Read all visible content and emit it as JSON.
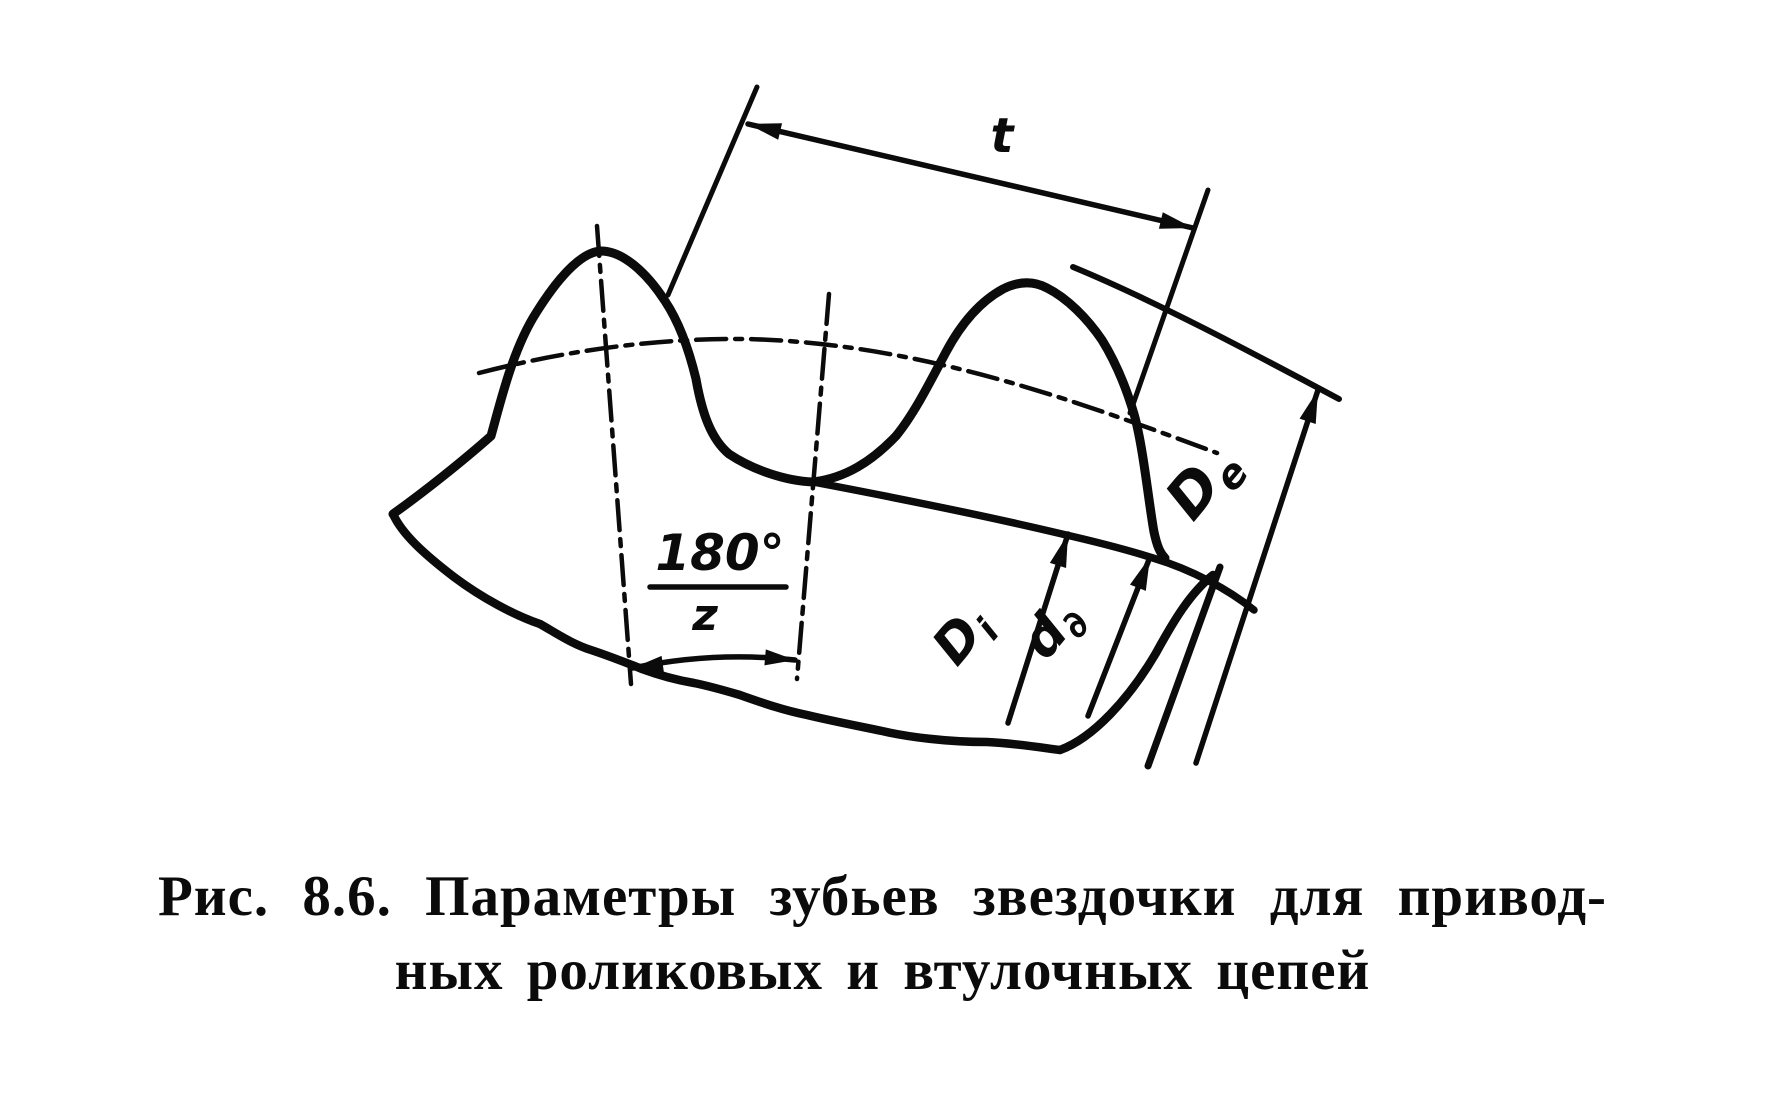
{
  "figure": {
    "caption_line1": "Рис. 8.6. Параметры зубьев звездочки для привод-",
    "caption_line2": "ных роликовых и втулочных цепей"
  },
  "labels": {
    "pitch": "t",
    "angle_numerator": "180°",
    "angle_denominator": "z",
    "tip_diameter_main": "D",
    "tip_diameter_sub": "e",
    "root_diameter_main": "D",
    "root_diameter_sub": "i",
    "pitch_diameter_main": "d",
    "pitch_diameter_sub": "∂"
  },
  "colors": {
    "ink": "#0b0b0b",
    "paper": "#ffffff"
  }
}
